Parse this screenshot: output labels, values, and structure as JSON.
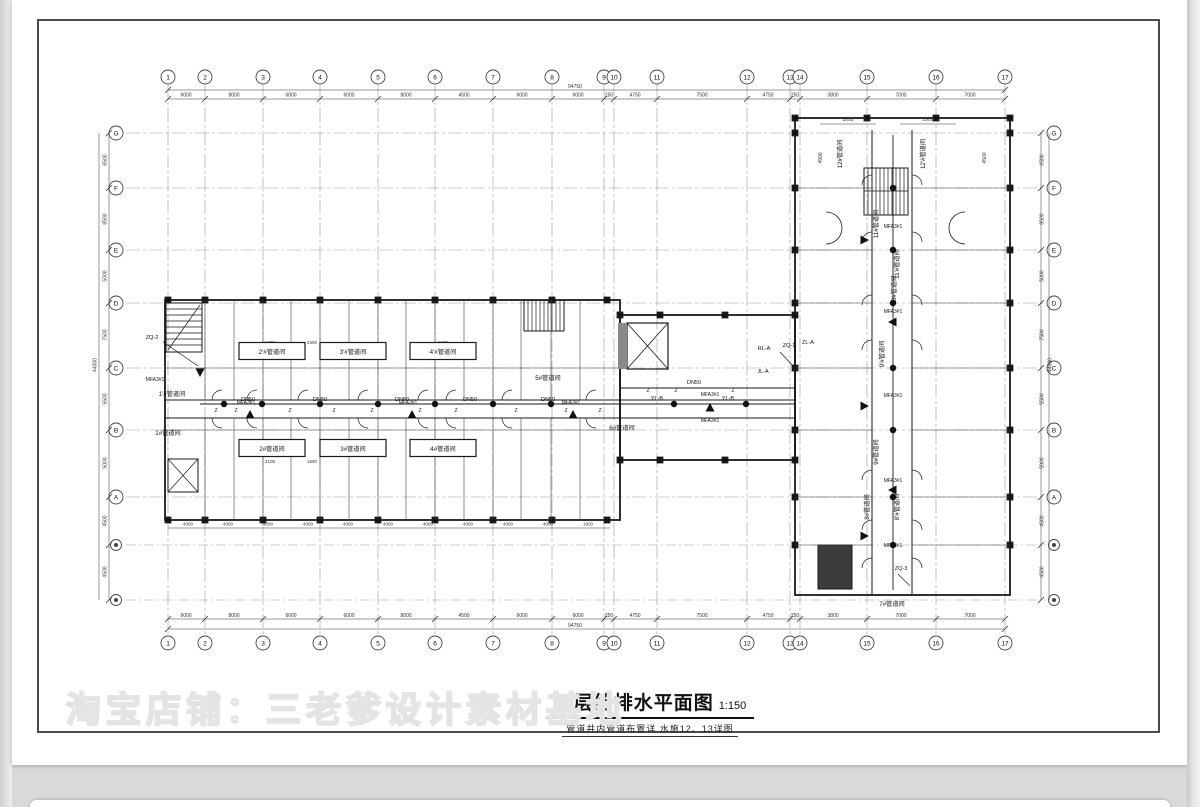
{
  "watermark": "淘宝店铺：三老爹设计素材基地",
  "title": {
    "main": "三层给排水平面图",
    "scale": "1:150",
    "subtitle": "管道井内管道布置详 水施12、13详图"
  },
  "axes": {
    "top": [
      {
        "n": "1",
        "x": 168
      },
      {
        "n": "2",
        "x": 205
      },
      {
        "n": "3",
        "x": 263
      },
      {
        "n": "4",
        "x": 320
      },
      {
        "n": "5",
        "x": 378
      },
      {
        "n": "6",
        "x": 435
      },
      {
        "n": "7",
        "x": 493
      },
      {
        "n": "8",
        "x": 552
      },
      {
        "n": "9",
        "x": 604
      },
      {
        "n": "10",
        "x": 614
      },
      {
        "n": "11",
        "x": 657
      },
      {
        "n": "12",
        "x": 747
      },
      {
        "n": "13",
        "x": 790
      },
      {
        "n": "14",
        "x": 800
      },
      {
        "n": "15",
        "x": 867
      },
      {
        "n": "16",
        "x": 936
      },
      {
        "n": "17",
        "x": 1005
      }
    ],
    "side": [
      {
        "n": "G",
        "y": 133
      },
      {
        "n": "F",
        "y": 188
      },
      {
        "n": "E",
        "y": 250
      },
      {
        "n": "D",
        "y": 303
      },
      {
        "n": "C",
        "y": 368
      },
      {
        "n": "B",
        "y": 430
      },
      {
        "n": "A",
        "y": 497
      }
    ],
    "side_sub_y": [
      545,
      600
    ]
  },
  "dims": {
    "top_row": [
      {
        "t": "6000",
        "x": 186
      },
      {
        "t": "8000",
        "x": 234
      },
      {
        "t": "6000",
        "x": 291
      },
      {
        "t": "6000",
        "x": 349
      },
      {
        "t": "8000",
        "x": 406
      },
      {
        "t": "4500",
        "x": 464
      },
      {
        "t": "6000",
        "x": 522
      },
      {
        "t": "6000",
        "x": 578
      },
      {
        "t": "250",
        "x": 609
      },
      {
        "t": "4750",
        "x": 635
      },
      {
        "t": "7500",
        "x": 702
      },
      {
        "t": "4750",
        "x": 768
      },
      {
        "t": "250",
        "x": 795
      },
      {
        "t": "3800",
        "x": 833
      },
      {
        "t": "7000",
        "x": 901
      },
      {
        "t": "7000",
        "x": 970
      }
    ],
    "top_overall": "94750",
    "left_col": [
      {
        "t": "6500",
        "y": 160
      },
      {
        "t": "8500",
        "y": 219
      },
      {
        "t": "5000",
        "y": 276
      },
      {
        "t": "7500",
        "y": 335
      },
      {
        "t": "5500",
        "y": 399
      },
      {
        "t": "5000",
        "y": 463
      },
      {
        "t": "4500",
        "y": 521
      },
      {
        "t": "4500",
        "y": 572
      }
    ],
    "left_overall": "44000",
    "inner_bottom": [
      {
        "t": "4000",
        "x": 188
      },
      {
        "t": "4000",
        "x": 228
      },
      {
        "t": "4000",
        "x": 268
      },
      {
        "t": "4000",
        "x": 308
      },
      {
        "t": "4000",
        "x": 348
      },
      {
        "t": "4000",
        "x": 388
      },
      {
        "t": "4000",
        "x": 428
      },
      {
        "t": "4000",
        "x": 468
      },
      {
        "t": "4000",
        "x": 508
      },
      {
        "t": "4000",
        "x": 548
      },
      {
        "t": "1900",
        "x": 588
      }
    ],
    "wing_top": [
      {
        "t": "3000",
        "x": 848
      },
      {
        "t": "2900",
        "x": 928
      }
    ],
    "wing_side": [
      {
        "t": "4500",
        "x": 822,
        "y": 158
      },
      {
        "t": "4500",
        "x": 986,
        "y": 158
      }
    ],
    "interior": [
      {
        "t": "2400",
        "x": 270,
        "y": 344
      },
      {
        "t": "2400",
        "x": 312,
        "y": 344
      },
      {
        "t": "2400",
        "x": 443,
        "y": 344
      },
      {
        "t": "2100",
        "x": 270,
        "y": 463
      },
      {
        "t": "1500",
        "x": 312,
        "y": 463
      }
    ]
  },
  "rooms": [
    {
      "t": "1'#管道间",
      "x": 172,
      "y": 394
    },
    {
      "t": "1#管道间",
      "x": 168,
      "y": 433
    },
    {
      "t": "2'#管道间",
      "x": 272,
      "y": 352,
      "box": true
    },
    {
      "t": "2#管道间",
      "x": 272,
      "y": 449,
      "box": true
    },
    {
      "t": "3'#管道间",
      "x": 353,
      "y": 352,
      "box": true
    },
    {
      "t": "3#管道间",
      "x": 353,
      "y": 449,
      "box": true
    },
    {
      "t": "4'#管道间",
      "x": 443,
      "y": 352,
      "box": true
    },
    {
      "t": "4#管道间",
      "x": 443,
      "y": 449,
      "box": true
    },
    {
      "t": "5#管道间",
      "x": 548,
      "y": 378
    },
    {
      "t": "6#管道间",
      "x": 622,
      "y": 428
    },
    {
      "t": "7#管道间",
      "x": 892,
      "y": 604
    },
    {
      "t": "8#管道间",
      "x": 869,
      "y": 505,
      "rot": -90
    },
    {
      "t": "8'#管道间",
      "x": 899,
      "y": 505,
      "rot": -90
    },
    {
      "t": "9#管道间",
      "x": 878,
      "y": 450,
      "rot": -90
    },
    {
      "t": "9'#管道间",
      "x": 884,
      "y": 352,
      "rot": -90
    },
    {
      "t": "10#管道间",
      "x": 896,
      "y": 288,
      "rot": -90
    },
    {
      "t": "11#管道间",
      "x": 878,
      "y": 222,
      "rot": -90
    },
    {
      "t": "11'#管道间",
      "x": 899,
      "y": 262,
      "rot": -90
    },
    {
      "t": "12#管道间",
      "x": 842,
      "y": 152,
      "rot": -90
    },
    {
      "t": "12'#管道间",
      "x": 925,
      "y": 152,
      "rot": -90
    }
  ],
  "pipes": {
    "dn50_label": "DN50",
    "dn50": [
      {
        "x": 248,
        "y": 401
      },
      {
        "x": 320,
        "y": 401
      },
      {
        "x": 402,
        "y": 401
      },
      {
        "x": 470,
        "y": 401
      },
      {
        "x": 548,
        "y": 401
      },
      {
        "x": 694,
        "y": 384
      }
    ],
    "z_label": "Z",
    "z_marks": [
      {
        "x": 216,
        "y": 412
      },
      {
        "x": 236,
        "y": 412
      },
      {
        "x": 290,
        "y": 412
      },
      {
        "x": 334,
        "y": 412
      },
      {
        "x": 372,
        "y": 412
      },
      {
        "x": 420,
        "y": 412
      },
      {
        "x": 456,
        "y": 412
      },
      {
        "x": 516,
        "y": 412
      },
      {
        "x": 566,
        "y": 412
      },
      {
        "x": 600,
        "y": 412
      },
      {
        "x": 648,
        "y": 392
      },
      {
        "x": 676,
        "y": 392
      },
      {
        "x": 733,
        "y": 392
      }
    ]
  },
  "equipment": {
    "mfa_label": "MFA3#1",
    "mfa_positions": [
      {
        "x": 155,
        "y": 381
      },
      {
        "x": 246,
        "y": 404
      },
      {
        "x": 408,
        "y": 404
      },
      {
        "x": 571,
        "y": 404
      },
      {
        "x": 710,
        "y": 396
      },
      {
        "x": 710,
        "y": 422
      },
      {
        "x": 893,
        "y": 228
      },
      {
        "x": 893,
        "y": 313
      },
      {
        "x": 893,
        "y": 397
      },
      {
        "x": 893,
        "y": 482
      },
      {
        "x": 893,
        "y": 547
      }
    ],
    "triangles": [
      {
        "x": 200,
        "y": 372,
        "dir": "down"
      },
      {
        "x": 250,
        "y": 415,
        "dir": "up"
      },
      {
        "x": 412,
        "y": 415,
        "dir": "up"
      },
      {
        "x": 573,
        "y": 415,
        "dir": "up"
      },
      {
        "x": 710,
        "y": 408,
        "dir": "up"
      },
      {
        "x": 864,
        "y": 240,
        "dir": "right"
      },
      {
        "x": 893,
        "y": 322,
        "dir": "left"
      },
      {
        "x": 864,
        "y": 406,
        "dir": "right"
      },
      {
        "x": 893,
        "y": 490,
        "dir": "left"
      },
      {
        "x": 864,
        "y": 536,
        "dir": "right"
      }
    ]
  },
  "special_labels": [
    {
      "t": "ZQ-2",
      "x": 152,
      "y": 339
    },
    {
      "t": "RL-A",
      "x": 764,
      "y": 350
    },
    {
      "t": "ZQ-1",
      "x": 789,
      "y": 347
    },
    {
      "t": "ZL-A",
      "x": 808,
      "y": 344
    },
    {
      "t": "JL-A",
      "x": 763,
      "y": 373
    },
    {
      "t": "ZQ-3",
      "x": 901,
      "y": 570
    },
    {
      "t": "YL-B",
      "x": 657,
      "y": 400
    },
    {
      "t": "YL-B",
      "x": 728,
      "y": 400
    }
  ],
  "colors": {
    "wall": "#1a1a1a",
    "grid": "#9a9a9a",
    "dim": "#333333",
    "page_bg": "#d9d9d9"
  }
}
